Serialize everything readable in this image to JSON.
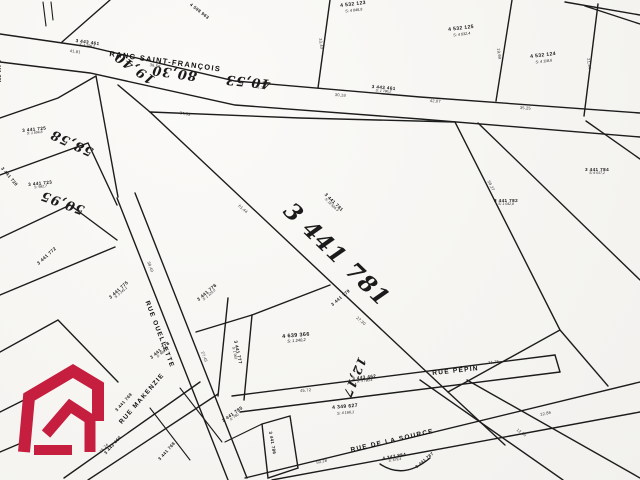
{
  "map": {
    "colors": {
      "ink": "#1c1c1c",
      "paper": "#f6f5f2",
      "shaded_lot_fill": "#e7e6e2",
      "logo_red": "#c51e3f"
    },
    "highlight": {
      "lot_number": "3 441 781"
    },
    "streets": [
      {
        "text": "RANG SAINT-FRANÇOIS",
        "x": 110,
        "y": 50,
        "rot": 8,
        "fs": 7.5
      },
      {
        "text": "RUE OUELLETTE",
        "x": 150,
        "y": 300,
        "rot": 69,
        "fs": 6.5
      },
      {
        "text": "RUE PÉPIN",
        "x": 432,
        "y": 370,
        "rot": -6,
        "fs": 6.5
      },
      {
        "text": "RUE DE LA SOURCE",
        "x": 350,
        "y": 447,
        "rot": -13,
        "fs": 6.5
      },
      {
        "text": "RUE MAKENZIE",
        "x": 118,
        "y": 421,
        "rot": -49,
        "fs": 6.5
      }
    ],
    "road_parcels": [
      {
        "text": "3 443 461",
        "sub": "S: 1 796,2",
        "x": 76,
        "y": 38,
        "rot": 8,
        "fs": 4.6
      },
      {
        "text": "3 443 461",
        "sub": "S: 1 796,2",
        "x": 372,
        "y": 84,
        "rot": 5,
        "fs": 4.6
      },
      {
        "text": "3 443 462",
        "sub": "S: 3 780,4",
        "x": 352,
        "y": 376,
        "rot": -6,
        "fs": 4.6
      },
      {
        "text": "3 443 460",
        "sub": "",
        "x": 103,
        "y": 452,
        "rot": -48,
        "fs": 4.4
      }
    ],
    "lots": [
      {
        "text": "4 532 123",
        "sub": "S: 4 046,9",
        "x": 340,
        "y": 4,
        "rot": -7,
        "fs": 5
      },
      {
        "text": "4 532 125",
        "sub": "S: 4 032,4",
        "x": 448,
        "y": 28,
        "rot": -7,
        "fs": 5
      },
      {
        "text": "4 532 124",
        "sub": "S: 4 118,6",
        "x": 530,
        "y": 55,
        "rot": -7,
        "fs": 5
      },
      {
        "text": "4 598 963",
        "sub": "",
        "x": 192,
        "y": 2,
        "rot": 38,
        "fs": 4.4
      },
      {
        "text": "3 441 784",
        "sub": "S: 6 017,2",
        "x": 585,
        "y": 167,
        "rot": 0,
        "fs": 4.6
      },
      {
        "text": "3 441 782",
        "sub": "S: 1 042,8",
        "x": 494,
        "y": 198,
        "rot": 0,
        "fs": 4.6
      },
      {
        "text": "3 441 781",
        "sub": "S: 18 505,3",
        "x": 327,
        "y": 192,
        "rot": 44,
        "fs": 4.6
      },
      {
        "text": "3 441 725",
        "sub": "S: 1 504,8",
        "x": 22,
        "y": 128,
        "rot": -6,
        "fs": 4.6
      },
      {
        "text": "3 441 723",
        "sub": "S: 982,7",
        "x": 28,
        "y": 182,
        "rot": -6,
        "fs": 4.6
      },
      {
        "text": "3 441 721",
        "sub": "",
        "x": 2,
        "y": 60,
        "rot": 90,
        "fs": 4.4
      },
      {
        "text": "3 441 720",
        "sub": "",
        "x": 4,
        "y": 166,
        "rot": 50,
        "fs": 4.4
      },
      {
        "text": "3 441 772",
        "sub": "",
        "x": 36,
        "y": 262,
        "rot": -42,
        "fs": 4.6
      },
      {
        "text": "3 441 775",
        "sub": "S: 3 241,1",
        "x": 108,
        "y": 296,
        "rot": -42,
        "fs": 4.6
      },
      {
        "text": "3 441 776",
        "sub": "S: 1 125,0",
        "x": 196,
        "y": 298,
        "rot": -40,
        "fs": 4.6
      },
      {
        "text": "3 441 777",
        "sub": "S: 1 062",
        "x": 238,
        "y": 340,
        "rot": 78,
        "fs": 4.6
      },
      {
        "text": "4 639 366",
        "sub": "S: 1 240,2",
        "x": 282,
        "y": 334,
        "rot": -5,
        "fs": 5.4
      },
      {
        "text": "3 441 778",
        "sub": "S: 980,5",
        "x": 149,
        "y": 356,
        "rot": -40,
        "fs": 4.6
      },
      {
        "text": "3 441 779",
        "sub": "",
        "x": 330,
        "y": 303,
        "rot": -40,
        "fs": 4.4
      },
      {
        "text": "4 349 627",
        "sub": "S: 4 166,1",
        "x": 332,
        "y": 406,
        "rot": -5,
        "fs": 5
      },
      {
        "text": "3 441 785",
        "sub": "S: 760",
        "x": 221,
        "y": 419,
        "rot": -35,
        "fs": 4.6
      },
      {
        "text": "3 441 786",
        "sub": "",
        "x": 273,
        "y": 431,
        "rot": 80,
        "fs": 4.4
      },
      {
        "text": "4 347 884",
        "sub": "S: 679,4",
        "x": 382,
        "y": 456,
        "rot": -10,
        "fs": 4.6
      },
      {
        "text": "3 441 769",
        "sub": "",
        "x": 114,
        "y": 409,
        "rot": -48,
        "fs": 4.4
      },
      {
        "text": "3 441 768",
        "sub": "",
        "x": 157,
        "y": 458,
        "rot": -48,
        "fs": 4.4
      },
      {
        "text": "3 441 787",
        "sub": "",
        "x": 415,
        "y": 466,
        "rot": -40,
        "fs": 4.2
      }
    ],
    "handwritten": [
      {
        "text": "3 441 781",
        "x": 296,
        "y": 198,
        "rot": 44,
        "fs": 23
      },
      {
        "text": "19,40",
        "x": 150,
        "y": 86,
        "rot": 215,
        "fs": 13
      },
      {
        "text": "80,30",
        "x": 196,
        "y": 82,
        "rot": 188,
        "fs": 13
      },
      {
        "text": "40,53",
        "x": 270,
        "y": 90,
        "rot": 186,
        "fs": 13
      },
      {
        "text": "58,58",
        "x": 90,
        "y": 158,
        "rot": 205,
        "fs": 13
      },
      {
        "text": "50,95",
        "x": 82,
        "y": 216,
        "rot": 200,
        "fs": 13
      },
      {
        "text": "12,17",
        "x": 368,
        "y": 360,
        "rot": 112,
        "fs": 12
      }
    ],
    "dims": [
      {
        "text": "41,81",
        "x": 70,
        "y": 49,
        "rot": 8
      },
      {
        "text": "36,58",
        "x": 150,
        "y": 63,
        "rot": 10
      },
      {
        "text": "45,12",
        "x": 255,
        "y": 85,
        "rot": 7
      },
      {
        "text": "30,18",
        "x": 335,
        "y": 93,
        "rot": 4
      },
      {
        "text": "42,07",
        "x": 430,
        "y": 99,
        "rot": 4
      },
      {
        "text": "35,25",
        "x": 520,
        "y": 106,
        "rot": 3
      },
      {
        "text": "24,39",
        "x": 180,
        "y": 111,
        "rot": 10
      },
      {
        "text": "61,44",
        "x": 240,
        "y": 204,
        "rot": 41
      },
      {
        "text": "27,30",
        "x": 358,
        "y": 316,
        "rot": 41
      },
      {
        "text": "58,27",
        "x": 490,
        "y": 180,
        "rot": 62
      },
      {
        "text": "38,40",
        "x": 150,
        "y": 261,
        "rot": 69
      },
      {
        "text": "27,45",
        "x": 204,
        "y": 351,
        "rot": 69
      },
      {
        "text": "45,72",
        "x": 300,
        "y": 389,
        "rot": -5
      },
      {
        "text": "31,75",
        "x": 488,
        "y": 361,
        "rot": -6
      },
      {
        "text": "50,28",
        "x": 316,
        "y": 461,
        "rot": -13
      },
      {
        "text": "22,86",
        "x": 540,
        "y": 413,
        "rot": -13
      },
      {
        "text": "33,40",
        "x": 322,
        "y": 38,
        "rot": 82
      },
      {
        "text": "19,99",
        "x": 500,
        "y": 48,
        "rot": 82
      },
      {
        "text": "21,34",
        "x": 590,
        "y": 58,
        "rot": 82
      },
      {
        "text": "12,50",
        "x": 518,
        "y": 428,
        "rot": 35
      },
      {
        "text": "15,24",
        "x": 99,
        "y": 451,
        "rot": -48
      }
    ]
  }
}
